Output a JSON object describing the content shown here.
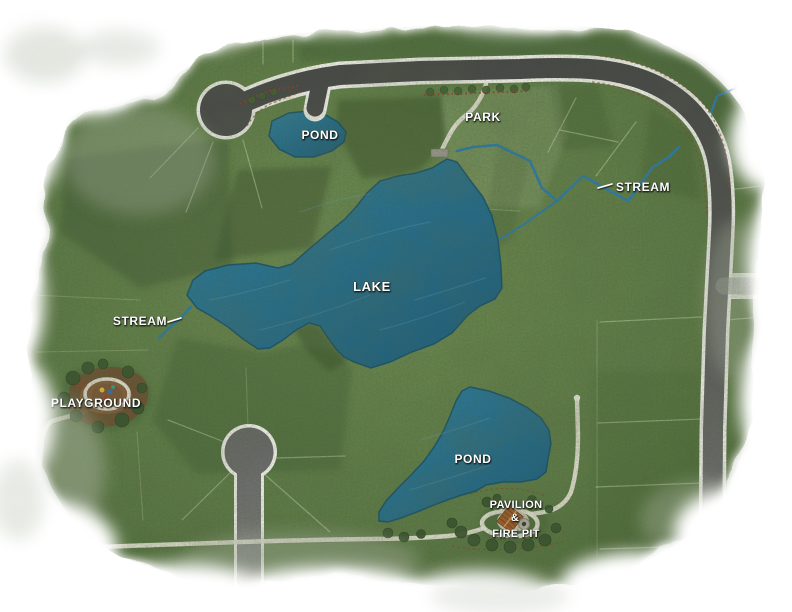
{
  "map": {
    "kind": "community-site-plan-watercolor-map",
    "labels": {
      "pond_top": "POND",
      "park": "PARK",
      "stream_right": "STREAM",
      "lake": "LAKE",
      "stream_left": "STREAM",
      "playground": "PLAYGROUND",
      "pond_bottom": "POND",
      "pavilion_line1": "PAVILION",
      "pavilion_line2": "&",
      "pavilion_line3": "FIRE PIT"
    },
    "colors": {
      "water": "#2b7390",
      "water_deep": "#1f5d7b",
      "water_edge": "#174f68",
      "stream": "#2f7cab",
      "grass": "#5e7a45",
      "grass_dark": "#3f5830",
      "road": "#4f4f4f",
      "curb": "#f1f0ea",
      "trail": "#e6e3d6",
      "flower_red": "#a33b28",
      "mulch": "#6f5134",
      "pavilion_roof": "#a55d28",
      "label_text": "#ffffff"
    }
  }
}
